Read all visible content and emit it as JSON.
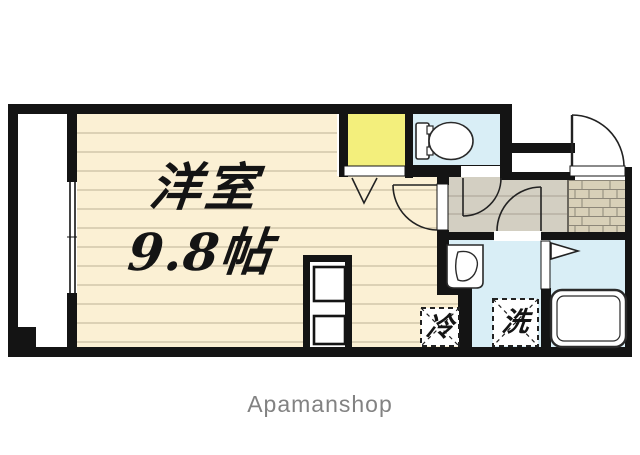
{
  "plan": {
    "brand": "Apamanshop",
    "rooms": {
      "main": {
        "name": "洋室",
        "size": "9.8帖"
      },
      "refrigerator_label": "冷",
      "laundry_label": "洗"
    },
    "colors": {
      "wall": "#141414",
      "floor": "#FBF0D4",
      "floor_line": "#BEB296",
      "hallway": "#D3CFC2",
      "hallway_line": "#A9A294",
      "water_room": "#D9EEF6",
      "closet": "#F3EF7C",
      "entrance_tile": "#D8D0B8",
      "brand_text": "#828282"
    }
  }
}
